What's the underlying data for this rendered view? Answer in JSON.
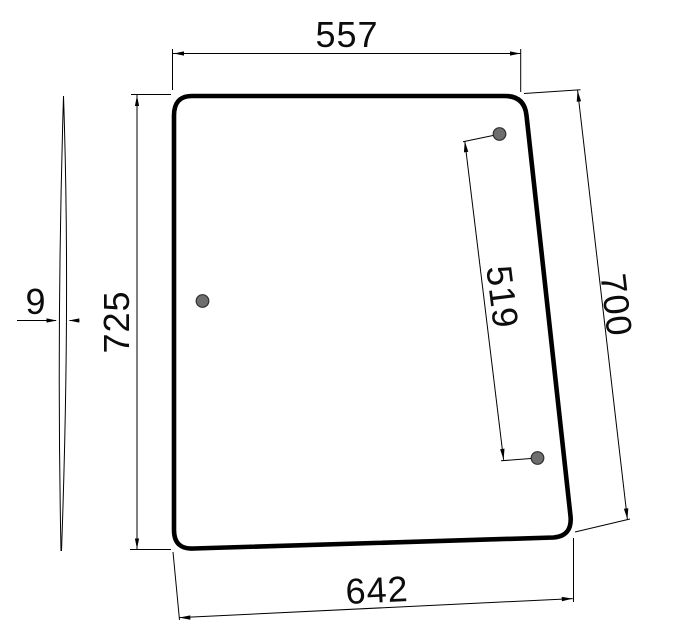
{
  "dimensions": {
    "top_width": "557",
    "bottom_width": "642",
    "left_height": "725",
    "right_height": "700",
    "hole_spacing": "519",
    "profile_thickness": "9"
  },
  "colors": {
    "line": "#000000",
    "hole_fill": "#6e6e6e",
    "hole_stroke": "#2f2f2f",
    "background": "#ffffff"
  }
}
